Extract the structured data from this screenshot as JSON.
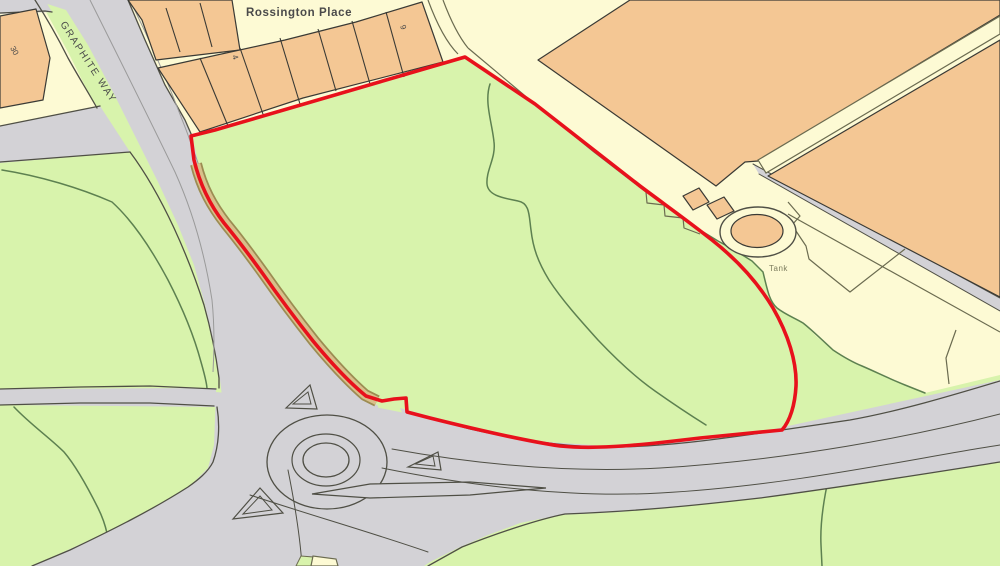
{
  "map": {
    "labels": {
      "street_top": "Rossington Place",
      "street_left": "GRAPHITE WAY",
      "tank": "Tank",
      "number_30": "30",
      "number_4": "4",
      "number_9": "9"
    },
    "colors": {
      "field_green": "#D8F3AC",
      "land_cream": "#FDFAD4",
      "building_orange": "#F4C794",
      "road_grey": "#D3D2D6",
      "road_edge": "#4F4F45",
      "kerb_grey": "#9A9A9A",
      "path_olive": "#6B6B50",
      "verge_tan": "#D8BF8A",
      "verge_edge": "#9C8C52",
      "boundary_red": "#E8111C",
      "field_line": "#5D8050",
      "text_dark": "#4A4A4A",
      "text_olive": "#7C7C5E"
    }
  }
}
